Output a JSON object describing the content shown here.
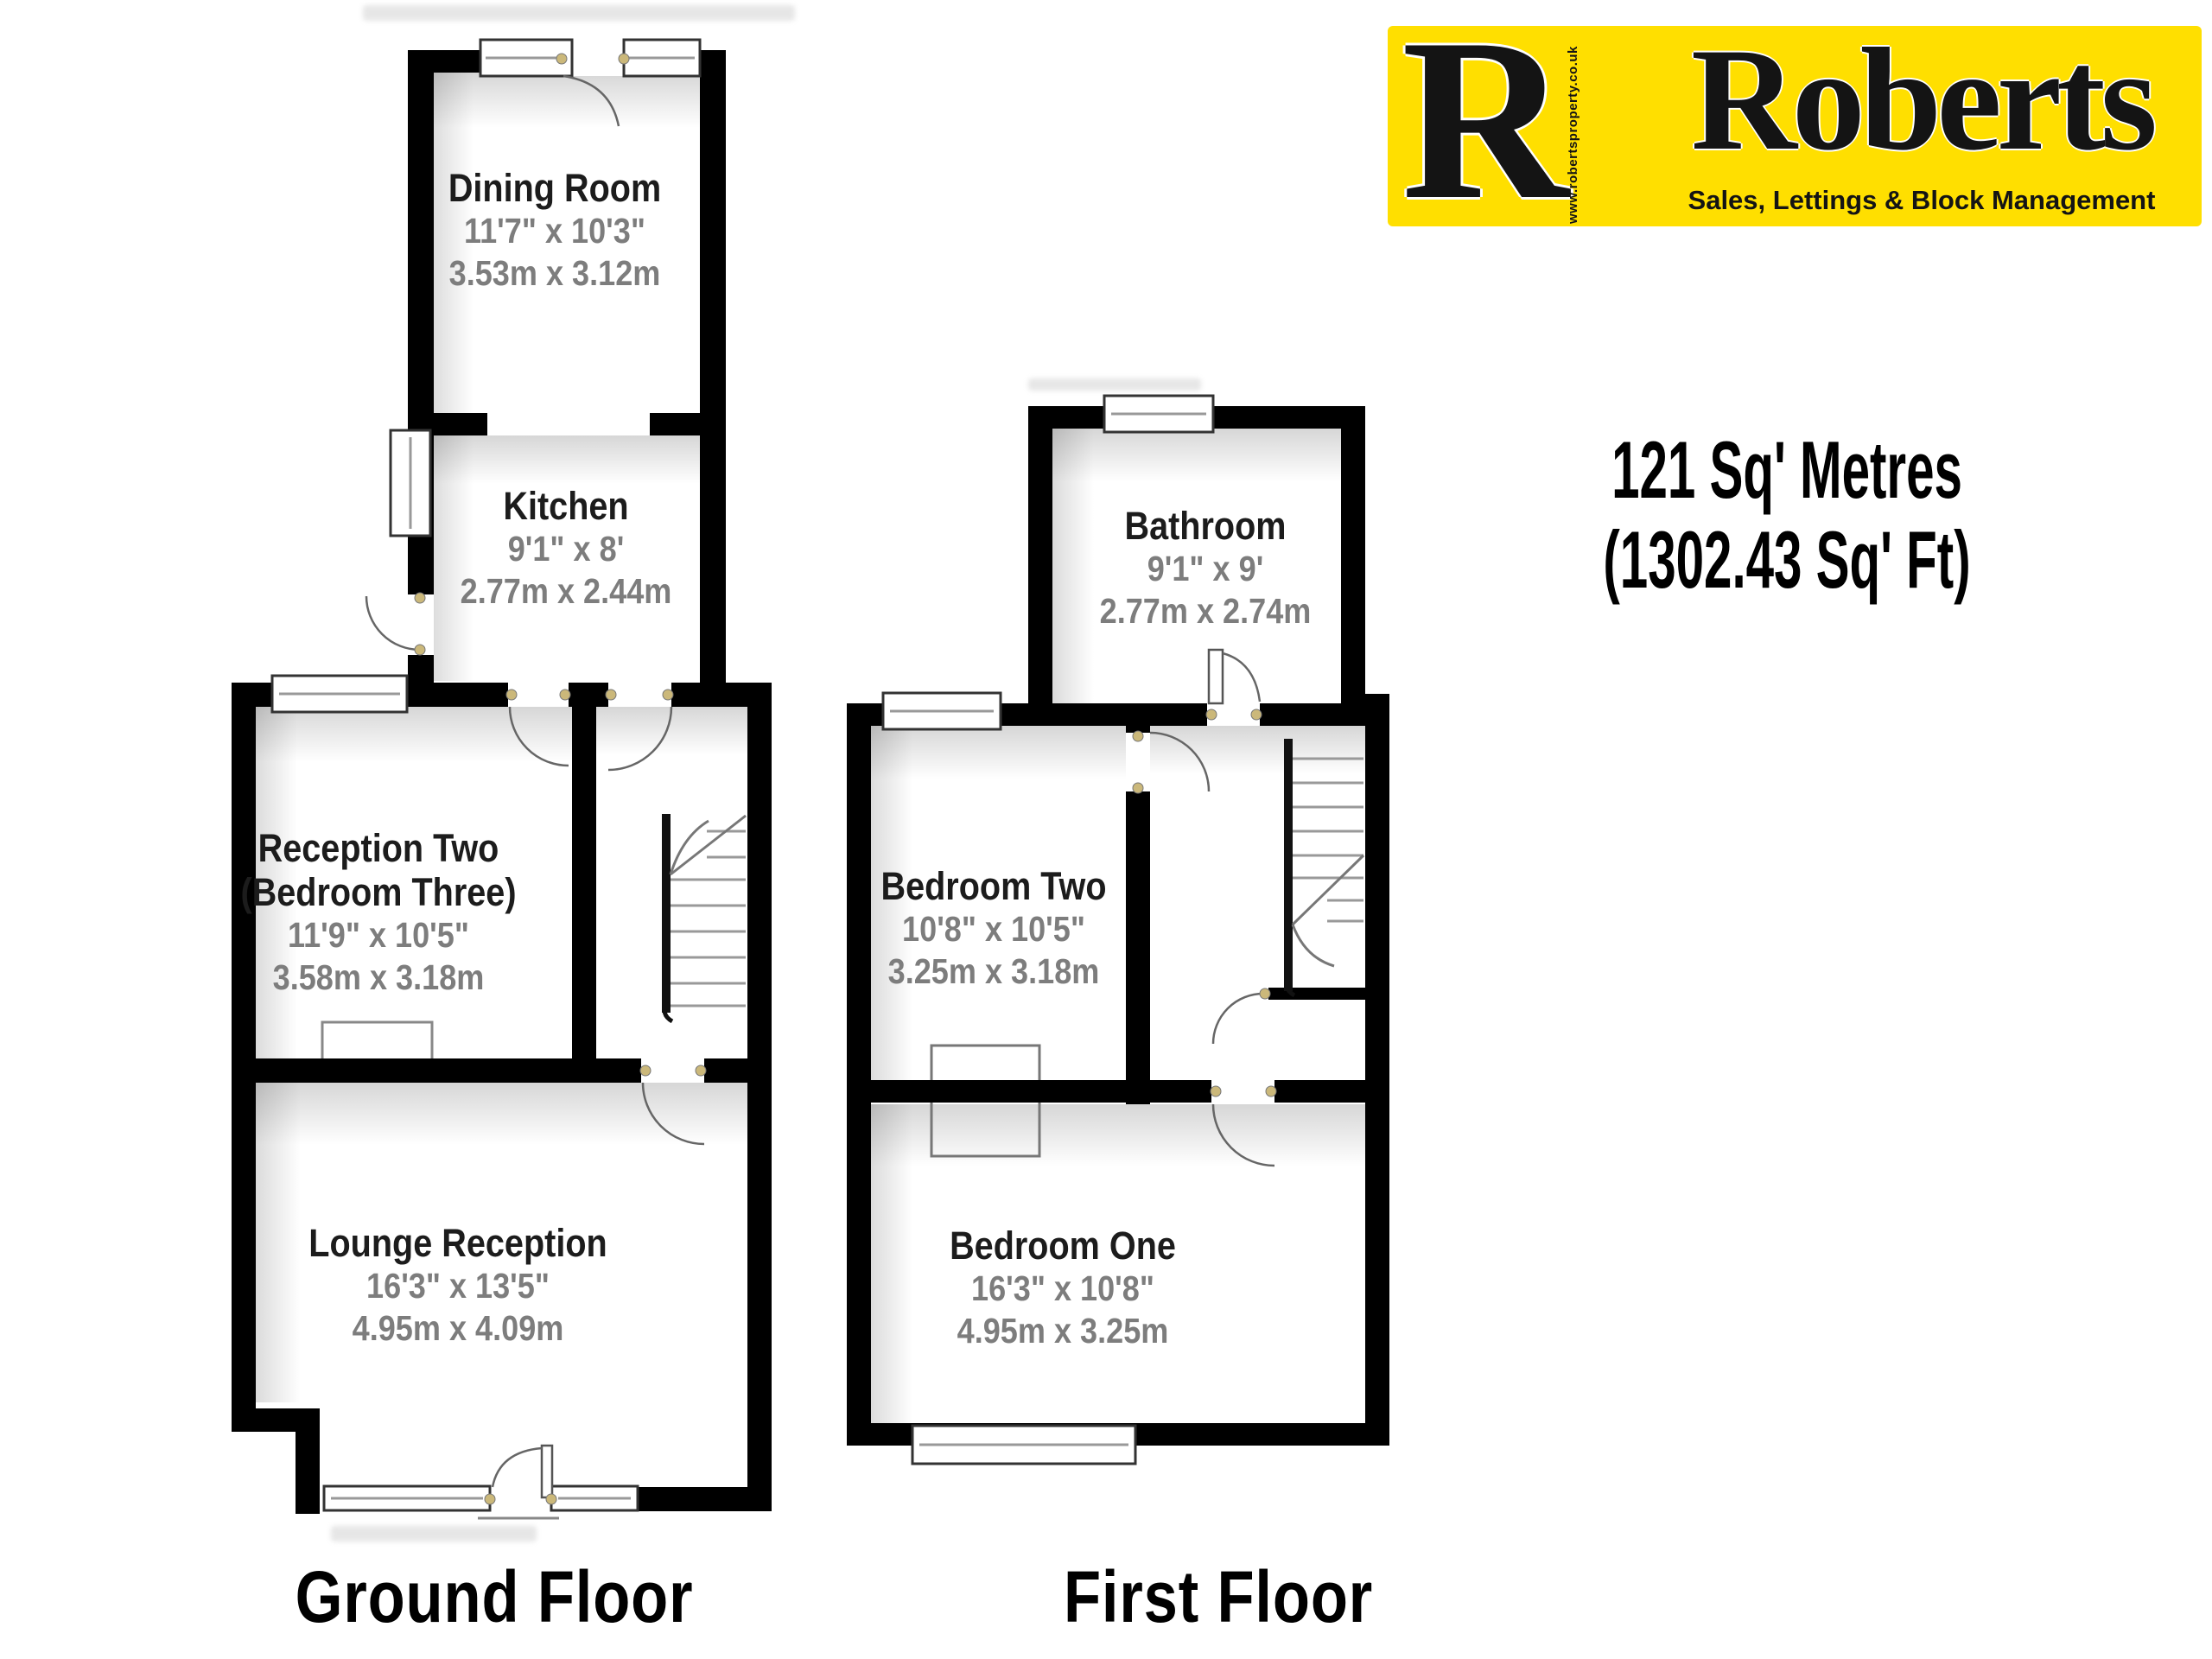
{
  "logo": {
    "r_initial": "R",
    "brand": "Roberts",
    "tagline": "Sales, Lettings & Block Management",
    "website_vertical": "www.robertsproperty.co.uk",
    "bg_color": "#FFDF00",
    "text_color": "#141414"
  },
  "summary": {
    "line1": "121 Sq' Metres",
    "line2": "(1302.43 Sq' Ft)"
  },
  "floors": [
    {
      "id": "ground",
      "label": "Ground Floor",
      "rooms": [
        {
          "id": "dining",
          "name": "Dining Room",
          "imperial": "11'7\" x 10'3\"",
          "metric": "3.53m x 3.12m"
        },
        {
          "id": "kitchen",
          "name": "Kitchen",
          "imperial": "9'1\" x 8'",
          "metric": "2.77m x 2.44m"
        },
        {
          "id": "reception2",
          "name": "Reception Two",
          "name2": "(Bedroom Three)",
          "imperial": "11'9\" x 10'5\"",
          "metric": "3.58m x 3.18m"
        },
        {
          "id": "lounge",
          "name": "Lounge Reception",
          "imperial": "16'3\" x 13'5\"",
          "metric": "4.95m x 4.09m"
        }
      ]
    },
    {
      "id": "first",
      "label": "First Floor",
      "rooms": [
        {
          "id": "bathroom",
          "name": "Bathroom",
          "imperial": "9'1\" x 9'",
          "metric": "2.77m x 2.74m"
        },
        {
          "id": "bed2",
          "name": "Bedroom Two",
          "imperial": "10'8\" x 10'5\"",
          "metric": "3.25m x 3.18m"
        },
        {
          "id": "bed1",
          "name": "Bedroom One",
          "imperial": "16'3\" x 10'8\"",
          "metric": "4.95m x 3.25m"
        }
      ]
    }
  ],
  "plan_colors": {
    "wall": "#000000",
    "room_text": "#1c1c1c",
    "dim_text": "#7d7d7d",
    "window_fill": "#ffffff",
    "stair_line": "#999999",
    "hinge_dot": "#cbb87a"
  }
}
